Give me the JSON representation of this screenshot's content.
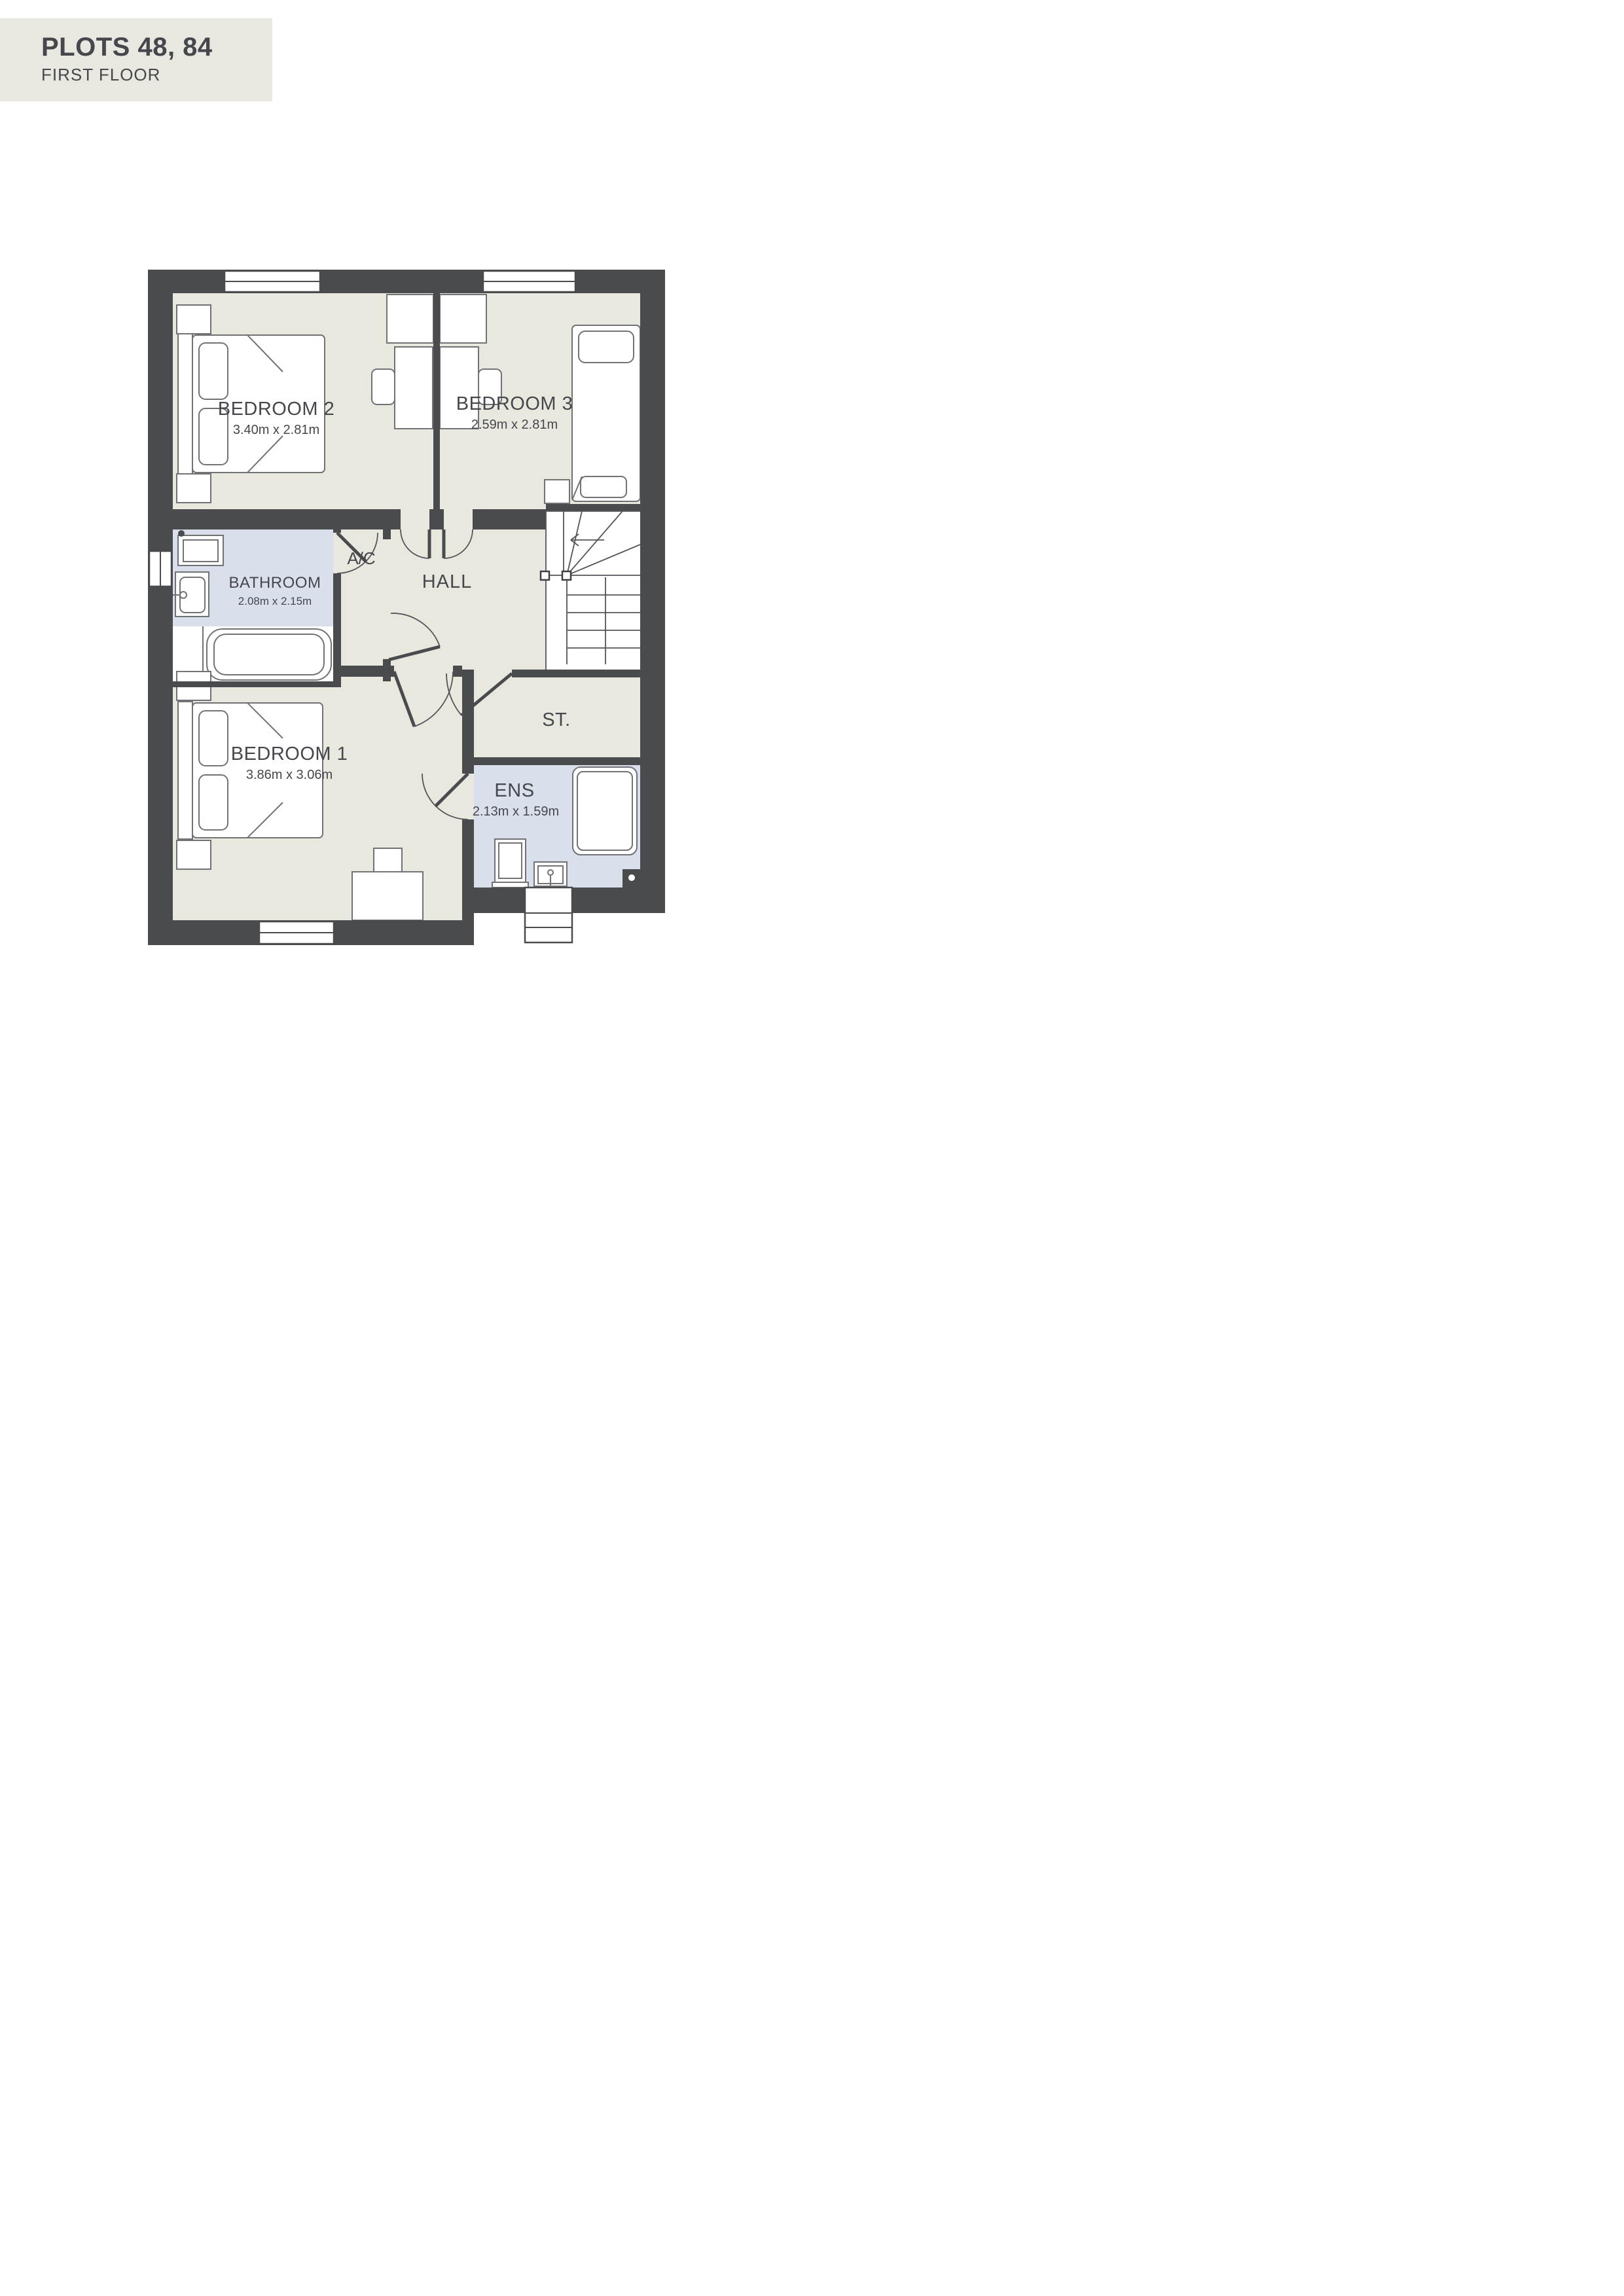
{
  "header": {
    "title": "PLOTS 48, 84",
    "subtitle": "FIRST FLOOR"
  },
  "rooms": {
    "bedroom2": {
      "name": "BEDROOM 2",
      "dims": "3.40m x 2.81m"
    },
    "bedroom3": {
      "name": "BEDROOM 3",
      "dims": "2.59m x 2.81m"
    },
    "bathroom": {
      "name": "BATHROOM",
      "dims": "2.08m x 2.15m"
    },
    "bedroom1": {
      "name": "BEDROOM 1",
      "dims": "3.86m x 3.06m"
    },
    "ensuite": {
      "name": "ENS",
      "dims": "2.13m x 1.59m"
    },
    "hall": {
      "name": "HALL"
    },
    "airing": {
      "name": "A/C"
    },
    "store": {
      "name": "ST."
    }
  },
  "colors": {
    "wall": "#4a4b4d",
    "floor": "#e9e8df",
    "wet": "#d9dfeb",
    "header_bg": "#e8e8e0",
    "ink": "#46474c",
    "furn_line": "#717276",
    "stair_line": "#54555a"
  }
}
